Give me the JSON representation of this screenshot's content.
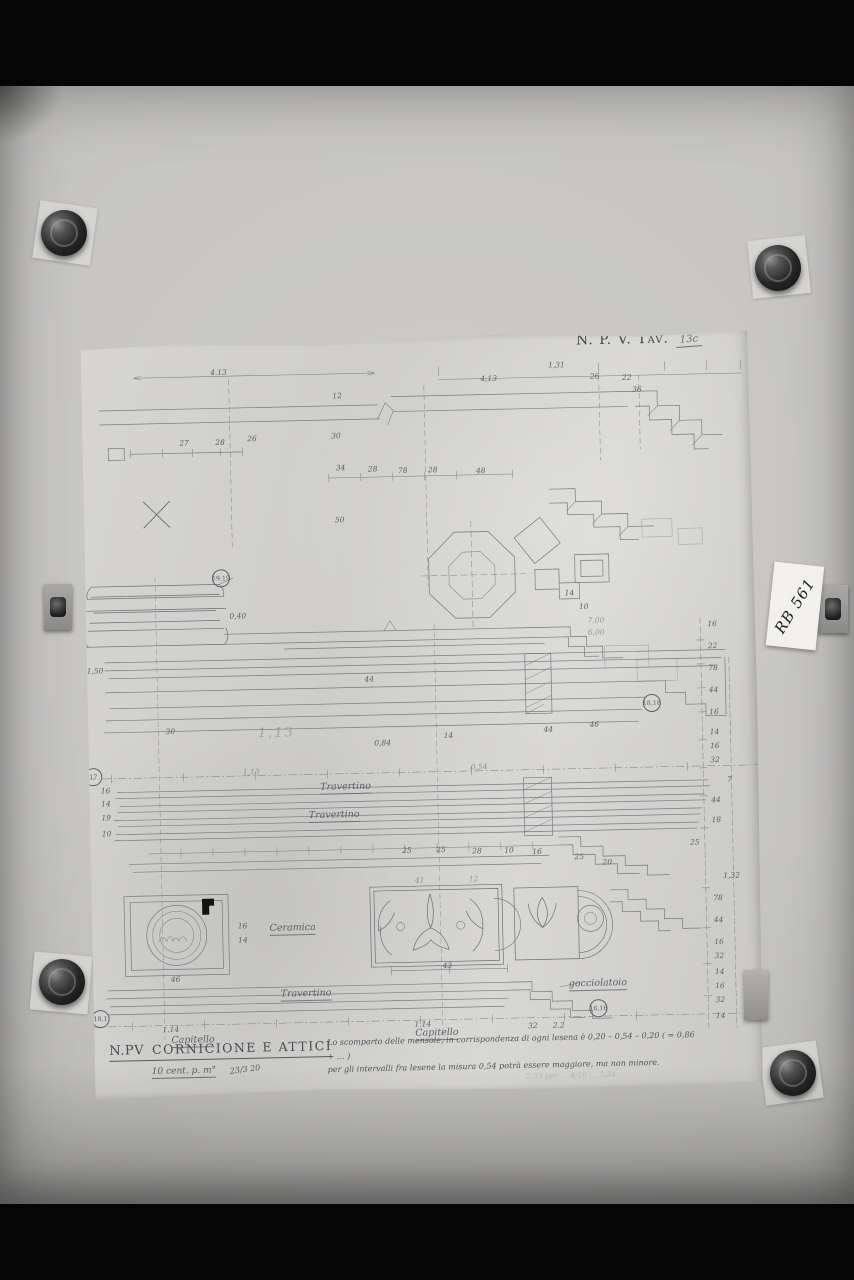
{
  "photo": {
    "tav_label": "N. P. V. Tav.",
    "tav_number": "13c",
    "archive_label": "RB 561"
  },
  "title_block": {
    "project": "N.PV",
    "title": "CORNICIONE E ATTICI",
    "scale": "10 cent. p. m°",
    "date": "23/3 20"
  },
  "notes": {
    "line1": "Lo scomparto delle mensole, in corrispondenza di ogni lesena è 0,20 – 0,54 – 0,20 ( = 0,86 + … )",
    "line2": "per gli intervalli fra lesene la misura 0,54 potrà essere maggiore, ma non minore.",
    "faint": "2,33 per …  4/10  …  7,34"
  },
  "annotations": [
    {
      "t": "4.13",
      "x": 140,
      "y": 34,
      "c": "dim"
    },
    {
      "t": "12",
      "x": 258,
      "y": 60,
      "c": "dim"
    },
    {
      "t": "4,13",
      "x": 410,
      "y": 46,
      "c": "dim"
    },
    {
      "t": "1,31",
      "x": 478,
      "y": 34,
      "c": "dim"
    },
    {
      "t": "26",
      "x": 516,
      "y": 46,
      "c": "dim"
    },
    {
      "t": "22",
      "x": 548,
      "y": 48,
      "c": "dim"
    },
    {
      "t": "36",
      "x": 558,
      "y": 60,
      "c": "dim"
    },
    {
      "t": "27",
      "x": 104,
      "y": 104,
      "c": "dim"
    },
    {
      "t": "28",
      "x": 140,
      "y": 104,
      "c": "dim"
    },
    {
      "t": "26",
      "x": 172,
      "y": 101,
      "c": "dim"
    },
    {
      "t": "30",
      "x": 256,
      "y": 100,
      "c": "dim"
    },
    {
      "t": "34",
      "x": 260,
      "y": 132,
      "c": "dim"
    },
    {
      "t": "28",
      "x": 292,
      "y": 134,
      "c": "dim"
    },
    {
      "t": "78",
      "x": 322,
      "y": 136,
      "c": "dim"
    },
    {
      "t": "28",
      "x": 352,
      "y": 136,
      "c": "dim"
    },
    {
      "t": "48",
      "x": 400,
      "y": 138,
      "c": "dim"
    },
    {
      "t": "50",
      "x": 258,
      "y": 184,
      "c": "dim"
    },
    {
      "t": "14",
      "x": 486,
      "y": 262,
      "c": "dim"
    },
    {
      "t": "10",
      "x": 500,
      "y": 276,
      "c": "dim"
    },
    {
      "t": "7,00",
      "x": 512,
      "y": 290,
      "c": "dimf"
    },
    {
      "t": "6,00",
      "x": 512,
      "y": 302,
      "c": "dimf"
    },
    {
      "t": "19,19",
      "x": 138,
      "y": 240,
      "c": "circ"
    },
    {
      "t": "0,40",
      "x": 154,
      "y": 278,
      "c": "dim"
    },
    {
      "t": "1,50",
      "x": 10,
      "y": 330,
      "c": "dim"
    },
    {
      "t": "44",
      "x": 284,
      "y": 344,
      "c": "dim"
    },
    {
      "t": "30",
      "x": 84,
      "y": 392,
      "c": "dim"
    },
    {
      "t": "1,13",
      "x": 190,
      "y": 396,
      "c": "big"
    },
    {
      "t": "0,84",
      "x": 296,
      "y": 408,
      "c": "dim"
    },
    {
      "t": "14",
      "x": 362,
      "y": 402,
      "c": "dim"
    },
    {
      "t": "44",
      "x": 462,
      "y": 398,
      "c": "dim"
    },
    {
      "t": "46",
      "x": 508,
      "y": 394,
      "c": "dim"
    },
    {
      "t": "18,18",
      "x": 566,
      "y": 374,
      "c": "circ"
    },
    {
      "t": "1,13",
      "x": 164,
      "y": 434,
      "c": "dimf"
    },
    {
      "t": "0,54",
      "x": 392,
      "y": 434,
      "c": "dimf"
    },
    {
      "t": "17",
      "x": 6,
      "y": 436,
      "c": "circ"
    },
    {
      "t": "16",
      "x": 18,
      "y": 450,
      "c": "dim"
    },
    {
      "t": "14",
      "x": 18,
      "y": 463,
      "c": "dim"
    },
    {
      "t": "19",
      "x": 18,
      "y": 477,
      "c": "dim"
    },
    {
      "t": "10",
      "x": 18,
      "y": 493,
      "c": "dim"
    },
    {
      "t": "Travertino",
      "x": 258,
      "y": 452,
      "c": "mat"
    },
    {
      "t": "Travertino",
      "x": 246,
      "y": 480,
      "c": "mat"
    },
    {
      "t": "25",
      "x": 318,
      "y": 516,
      "c": "dim"
    },
    {
      "t": "25",
      "x": 352,
      "y": 516,
      "c": "dim"
    },
    {
      "t": "28",
      "x": 388,
      "y": 518,
      "c": "dim"
    },
    {
      "t": "10",
      "x": 420,
      "y": 518,
      "c": "dim"
    },
    {
      "t": "16",
      "x": 448,
      "y": 520,
      "c": "dim"
    },
    {
      "t": "25",
      "x": 490,
      "y": 526,
      "c": "dim"
    },
    {
      "t": "20",
      "x": 518,
      "y": 532,
      "c": "dim"
    },
    {
      "t": "46",
      "x": 84,
      "y": 640,
      "c": "dim"
    },
    {
      "t": "16",
      "x": 152,
      "y": 588,
      "c": "dim"
    },
    {
      "t": "14",
      "x": 152,
      "y": 602,
      "c": "dim"
    },
    {
      "t": "Ceramica",
      "x": 202,
      "y": 592,
      "c": "mat"
    },
    {
      "t": "41",
      "x": 330,
      "y": 546,
      "c": "dimf"
    },
    {
      "t": "12",
      "x": 384,
      "y": 546,
      "c": "dimf"
    },
    {
      "t": "43",
      "x": 356,
      "y": 632,
      "c": "dim"
    },
    {
      "t": "Travertino",
      "x": 214,
      "y": 658,
      "c": "mat"
    },
    {
      "t": "gocciolatoio",
      "x": 506,
      "y": 654,
      "c": "mat"
    },
    {
      "t": "16,16",
      "x": 506,
      "y": 678,
      "c": "circ"
    },
    {
      "t": "18,1",
      "x": 8,
      "y": 678,
      "c": "circ"
    },
    {
      "t": "1.14",
      "x": 78,
      "y": 690,
      "c": "dim"
    },
    {
      "t": "Capitello",
      "x": 100,
      "y": 702,
      "c": "mat"
    },
    {
      "t": "1.14",
      "x": 330,
      "y": 690,
      "c": "dim"
    },
    {
      "t": "Capitello",
      "x": 344,
      "y": 700,
      "c": "mat"
    },
    {
      "t": "32",
      "x": 440,
      "y": 694,
      "c": "dim"
    },
    {
      "t": "2.2",
      "x": 466,
      "y": 694,
      "c": "dim"
    },
    {
      "t": "16",
      "x": 628,
      "y": 296,
      "c": "dim"
    },
    {
      "t": "22",
      "x": 628,
      "y": 318,
      "c": "dim"
    },
    {
      "t": "78",
      "x": 628,
      "y": 340,
      "c": "dim"
    },
    {
      "t": "44",
      "x": 628,
      "y": 362,
      "c": "dim"
    },
    {
      "t": "16",
      "x": 628,
      "y": 384,
      "c": "dim"
    },
    {
      "t": "14",
      "x": 628,
      "y": 404,
      "c": "dim"
    },
    {
      "t": "16",
      "x": 628,
      "y": 418,
      "c": "dim"
    },
    {
      "t": "32",
      "x": 628,
      "y": 432,
      "c": "dim"
    },
    {
      "t": "7",
      "x": 642,
      "y": 452,
      "c": "dim"
    },
    {
      "t": "44",
      "x": 628,
      "y": 472,
      "c": "dim"
    },
    {
      "t": "18",
      "x": 628,
      "y": 492,
      "c": "dim"
    },
    {
      "t": "25",
      "x": 606,
      "y": 514,
      "c": "dim"
    },
    {
      "t": "1,32",
      "x": 642,
      "y": 548,
      "c": "dim"
    },
    {
      "t": "78",
      "x": 628,
      "y": 570,
      "c": "dim"
    },
    {
      "t": "44",
      "x": 628,
      "y": 592,
      "c": "dim"
    },
    {
      "t": "16",
      "x": 628,
      "y": 614,
      "c": "dim"
    },
    {
      "t": "32",
      "x": 628,
      "y": 628,
      "c": "dim"
    },
    {
      "t": "14",
      "x": 628,
      "y": 644,
      "c": "dim"
    },
    {
      "t": "16",
      "x": 628,
      "y": 658,
      "c": "dim"
    },
    {
      "t": "32",
      "x": 628,
      "y": 672,
      "c": "dim"
    },
    {
      "t": "14",
      "x": 628,
      "y": 688,
      "c": "dim"
    }
  ]
}
